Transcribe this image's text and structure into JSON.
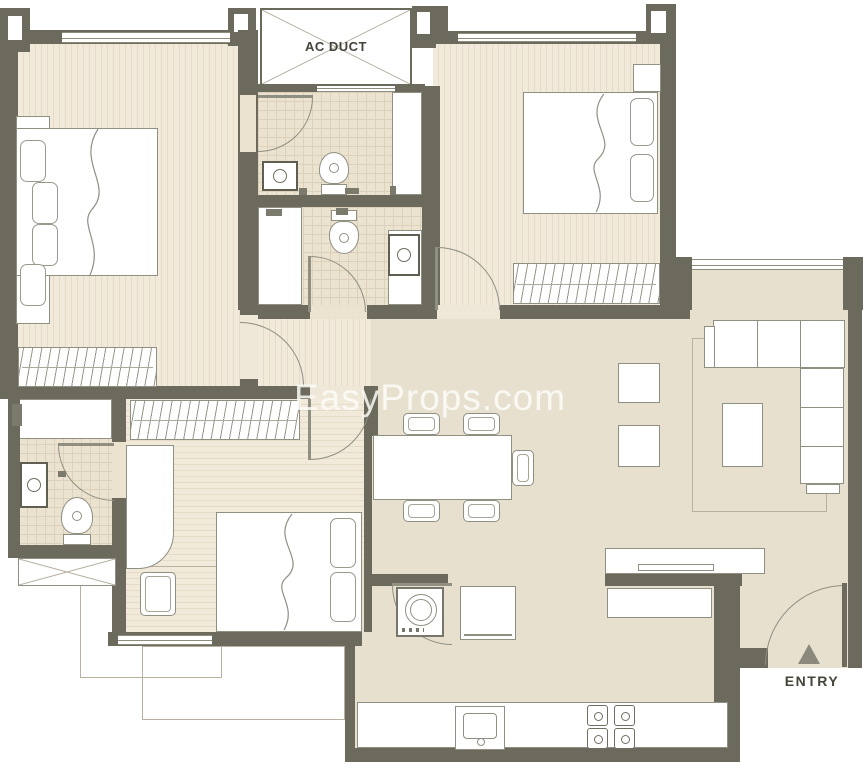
{
  "meta": {
    "description": "2BHK-style apartment floor plan drawing",
    "canvas": {
      "width": 866,
      "height": 768
    }
  },
  "labels": {
    "ac_duct": "AC DUCT",
    "entry": "ENTRY",
    "watermark": "EasyProps.com"
  },
  "colors": {
    "wall": "#6b6a5c",
    "floor_wood": "#f1e9d9",
    "floor_wood_stripe": "#e5dbc6",
    "floor_tile": "#ece2d0",
    "tile_line": "#dcd1bb",
    "floor_plain": "#e8e0cf",
    "furniture_line": "#8f8f82",
    "label_text": "#45443a",
    "watermark": "rgba(252,252,248,0.85)",
    "entry_triangle": "#8a897b"
  },
  "elements": [
    {
      "t": "floorw",
      "n": "bedroom-1-floor",
      "x": 18,
      "y": 44,
      "w": 222,
      "h": 342
    },
    {
      "t": "floorw",
      "n": "hallway-floor",
      "x": 258,
      "y": 310,
      "w": 114,
      "h": 76
    },
    {
      "t": "floorw",
      "n": "bedroom-2-floor",
      "x": 433,
      "y": 43,
      "w": 227,
      "h": 264
    },
    {
      "t": "floorwh",
      "n": "bedroom-3-floor",
      "x": 126,
      "y": 399,
      "w": 238,
      "h": 233
    },
    {
      "t": "floort",
      "n": "bath-1-floor",
      "x": 258,
      "y": 92,
      "w": 164,
      "h": 103
    },
    {
      "t": "floort",
      "n": "bath-2-floor",
      "x": 258,
      "y": 207,
      "w": 164,
      "h": 98
    },
    {
      "t": "floort",
      "n": "bath-3-floor",
      "x": 18,
      "y": 399,
      "w": 94,
      "h": 146
    },
    {
      "t": "floorp",
      "n": "living-dining-floor",
      "x": 372,
      "y": 310,
      "w": 476,
      "h": 350
    },
    {
      "t": "floorp",
      "n": "living-top-floor",
      "x": 676,
      "y": 262,
      "w": 172,
      "h": 48
    },
    {
      "t": "floorp",
      "n": "kitchen-floor",
      "x": 348,
      "y": 560,
      "w": 366,
      "h": 188
    },
    {
      "t": "floorp",
      "n": "entry-hall-floor",
      "x": 740,
      "y": 566,
      "w": 108,
      "h": 102
    },
    {
      "t": "rect",
      "n": "bath-1-shower",
      "x": 392,
      "y": 92,
      "w": 30,
      "h": 103
    },
    {
      "t": "rect",
      "n": "bath-2-counter",
      "x": 258,
      "y": 207,
      "w": 44,
      "h": 98
    },
    {
      "t": "rect",
      "n": "bath-2-shower",
      "x": 388,
      "y": 230,
      "w": 34,
      "h": 75
    },
    {
      "t": "rect",
      "n": "bath-3-shower",
      "x": 18,
      "y": 399,
      "w": 94,
      "h": 40
    },
    {
      "t": "trect",
      "n": "balcony-left",
      "x": 80,
      "y": 566,
      "w": 142,
      "h": 112
    },
    {
      "t": "trect",
      "n": "balcony-bottom",
      "x": 142,
      "y": 646,
      "w": 203,
      "h": 74
    },
    {
      "t": "wall",
      "n": "wall-top-left",
      "x": 0,
      "y": 30,
      "w": 256,
      "h": 14
    },
    {
      "t": "wall",
      "n": "wall-left",
      "x": 0,
      "y": 44,
      "w": 18,
      "h": 342
    },
    {
      "t": "wall",
      "n": "pillar-top-left",
      "x": 0,
      "y": 8,
      "w": 30,
      "h": 44
    },
    {
      "t": "white",
      "n": "pillar-top-left-notch",
      "x": 8,
      "y": 16,
      "w": 14,
      "h": 24
    },
    {
      "t": "wall",
      "n": "pillar-top-mid",
      "x": 228,
      "y": 8,
      "w": 28,
      "h": 38
    },
    {
      "t": "white",
      "n": "pillar-top-mid-notch",
      "x": 234,
      "y": 14,
      "w": 14,
      "h": 18
    },
    {
      "t": "wall",
      "n": "wall-bedroom1-right",
      "x": 238,
      "y": 30,
      "w": 20,
      "h": 280
    },
    {
      "t": "gapt",
      "n": "bath-1-door-gap",
      "x": 240,
      "y": 95,
      "w": 16,
      "h": 57
    },
    {
      "t": "wall",
      "n": "pillar-duct-right",
      "x": 412,
      "y": 6,
      "w": 24,
      "h": 42
    },
    {
      "t": "white",
      "n": "pillar-duct-right-notch",
      "x": 417,
      "y": 12,
      "w": 13,
      "h": 22
    },
    {
      "t": "wall",
      "n": "wall-top-bedroom2",
      "x": 430,
      "y": 31,
      "w": 220,
      "h": 13
    },
    {
      "t": "wall",
      "n": "pillar-bedroom2-left",
      "x": 430,
      "y": 6,
      "w": 18,
      "h": 36
    },
    {
      "t": "wall",
      "n": "pillar-bedroom2-right",
      "x": 646,
      "y": 4,
      "w": 30,
      "h": 40
    },
    {
      "t": "white",
      "n": "pillar-bedroom2-right-notch",
      "x": 651,
      "y": 11,
      "w": 15,
      "h": 22
    },
    {
      "t": "wall",
      "n": "wall-bedroom2-right",
      "x": 660,
      "y": 43,
      "w": 16,
      "h": 216
    },
    {
      "t": "wall",
      "n": "pillar-living-left",
      "x": 660,
      "y": 257,
      "w": 32,
      "h": 53
    },
    {
      "t": "wall",
      "n": "pillar-living-right",
      "x": 843,
      "y": 257,
      "w": 20,
      "h": 53
    },
    {
      "t": "wall",
      "n": "wall-living-right",
      "x": 848,
      "y": 266,
      "w": 14,
      "h": 402
    },
    {
      "t": "wall",
      "n": "wall-baths-right",
      "x": 422,
      "y": 86,
      "w": 18,
      "h": 224
    },
    {
      "t": "wall",
      "n": "wall-duct-bottom",
      "x": 258,
      "y": 84,
      "w": 167,
      "h": 8
    },
    {
      "t": "wall",
      "n": "wall-bath-divider",
      "x": 258,
      "y": 195,
      "w": 164,
      "h": 12
    },
    {
      "t": "wall",
      "n": "wall-mid",
      "x": 258,
      "y": 305,
      "w": 432,
      "h": 14
    },
    {
      "t": "gapt",
      "n": "bath-2-door-gap",
      "x": 310,
      "y": 305,
      "w": 57,
      "h": 14
    },
    {
      "t": "gapw",
      "n": "bedroom-2-door-gap",
      "x": 437,
      "y": 305,
      "w": 63,
      "h": 14
    },
    {
      "t": "wall",
      "n": "wall-hall-bottom",
      "x": 0,
      "y": 386,
      "w": 372,
      "h": 13
    },
    {
      "t": "gapw",
      "n": "bedroom-3-door-gap",
      "x": 310,
      "y": 386,
      "w": 61,
      "h": 13
    },
    {
      "t": "wall",
      "n": "wall-hall-vertical",
      "x": 240,
      "y": 310,
      "w": 18,
      "h": 76
    },
    {
      "t": "gapw",
      "n": "bedroom-1-door-gap",
      "x": 240,
      "y": 315,
      "w": 18,
      "h": 64
    },
    {
      "t": "wall",
      "n": "wall-bath3-left",
      "x": 8,
      "y": 399,
      "w": 12,
      "h": 159
    },
    {
      "t": "wall",
      "n": "wall-bath3-right",
      "x": 112,
      "y": 388,
      "w": 14,
      "h": 167
    },
    {
      "t": "gapt",
      "n": "bath-3-door-gap",
      "x": 112,
      "y": 442,
      "w": 14,
      "h": 56
    },
    {
      "t": "wall",
      "n": "wall-bath3-bottom",
      "x": 8,
      "y": 545,
      "w": 118,
      "h": 13
    },
    {
      "t": "wall",
      "n": "wall-bedroom3-right",
      "x": 364,
      "y": 386,
      "w": 14,
      "h": 50
    },
    {
      "t": "wall",
      "n": "wall-bedroom3-right-low",
      "x": 364,
      "y": 436,
      "w": 8,
      "h": 196
    },
    {
      "t": "wall",
      "n": "wall-bedroom3-bottom",
      "x": 108,
      "y": 632,
      "w": 254,
      "h": 14
    },
    {
      "t": "wall",
      "n": "wall-bedroom3-left-low",
      "x": 112,
      "y": 555,
      "w": 14,
      "h": 91
    },
    {
      "t": "wall",
      "n": "wall-kitchen-top",
      "x": 372,
      "y": 574,
      "w": 76,
      "h": 12
    },
    {
      "t": "wall",
      "n": "wall-half",
      "x": 605,
      "y": 574,
      "w": 137,
      "h": 12
    },
    {
      "t": "wall",
      "n": "wall-kitchen-entry",
      "x": 714,
      "y": 580,
      "w": 26,
      "h": 182
    },
    {
      "t": "wall",
      "n": "wall-entry-stub",
      "x": 740,
      "y": 648,
      "w": 28,
      "h": 20
    },
    {
      "t": "wall",
      "n": "wall-kitchen-bottom",
      "x": 345,
      "y": 748,
      "w": 385,
      "h": 14
    },
    {
      "t": "wall",
      "n": "wall-kitchen-left",
      "x": 345,
      "y": 585,
      "w": 10,
      "h": 177
    },
    {
      "t": "win",
      "n": "window-bedroom-1",
      "x": 62,
      "y": 32,
      "w": 168,
      "h": 11
    },
    {
      "t": "win",
      "n": "window-bedroom-2",
      "x": 458,
      "y": 33,
      "w": 178,
      "h": 9
    },
    {
      "t": "win",
      "n": "window-living",
      "x": 692,
      "y": 259,
      "w": 151,
      "h": 11
    },
    {
      "t": "win",
      "n": "window-bedroom-3",
      "x": 118,
      "y": 635,
      "w": 94,
      "h": 10
    },
    {
      "t": "win",
      "n": "window-bath-1",
      "x": 317,
      "y": 84,
      "w": 78,
      "h": 8
    },
    {
      "t": "xbox",
      "n": "ac-duct-box",
      "x": 260,
      "y": 8,
      "w": 152,
      "h": 78,
      "bw": 2
    },
    {
      "t": "xbox",
      "n": "shaft-box",
      "x": 18,
      "y": 558,
      "w": 98,
      "h": 28,
      "bw": 1
    },
    {
      "t": "arctl",
      "n": "bath-1-door-arc",
      "x": 258,
      "y": 97,
      "w": 55,
      "h": 55
    },
    {
      "t": "line",
      "n": "bath-1-door-leaf",
      "x": 258,
      "y": 95,
      "w": 55,
      "h": 3
    },
    {
      "t": "arcbl",
      "n": "bath-2-door-arc",
      "x": 310,
      "y": 256,
      "w": 56,
      "h": 56
    },
    {
      "t": "line",
      "n": "bath-2-door-leaf",
      "x": 308,
      "y": 256,
      "w": 3,
      "h": 56
    },
    {
      "t": "arcbl",
      "n": "bedroom-2-door-arc",
      "x": 437,
      "y": 247,
      "w": 63,
      "h": 63
    },
    {
      "t": "line",
      "n": "bedroom-2-door-leaf",
      "x": 435,
      "y": 247,
      "w": 3,
      "h": 63
    },
    {
      "t": "arcbl",
      "n": "bedroom-1-door-arc",
      "x": 240,
      "y": 322,
      "w": 64,
      "h": 64
    },
    {
      "t": "arctl",
      "n": "bedroom-3-door-arc",
      "x": 310,
      "y": 399,
      "w": 61,
      "h": 61
    },
    {
      "t": "line",
      "n": "bedroom-3-door-leaf",
      "x": 308,
      "y": 399,
      "w": 3,
      "h": 61
    },
    {
      "t": "arctr",
      "n": "bath-3-door-arc",
      "x": 58,
      "y": 445,
      "w": 56,
      "h": 56
    },
    {
      "t": "line",
      "n": "bath-3-door-leaf",
      "x": 58,
      "y": 443,
      "w": 56,
      "h": 3
    },
    {
      "t": "arctr",
      "n": "kitchen-door-arc",
      "x": 392,
      "y": 585,
      "w": 60,
      "h": 60
    },
    {
      "t": "line",
      "n": "kitchen-door-leaf",
      "x": 392,
      "y": 583,
      "w": 60,
      "h": 3
    },
    {
      "t": "arcbr",
      "n": "entry-door-arc",
      "x": 765,
      "y": 585,
      "w": 80,
      "h": 80
    },
    {
      "t": "line",
      "n": "entry-door-leaf",
      "x": 842,
      "y": 583,
      "w": 5,
      "h": 84,
      "c": "#6b6a5c"
    },
    {
      "t": "rect",
      "n": "bed-1-headboard",
      "x": 16,
      "y": 116,
      "w": 34,
      "h": 208
    },
    {
      "t": "rect",
      "n": "bed-1",
      "x": 16,
      "y": 128,
      "w": 142,
      "h": 148
    },
    {
      "t": "pillow",
      "n": "bed-1-pillow",
      "x": 20,
      "y": 140,
      "w": 26,
      "h": 42
    },
    {
      "t": "pillow",
      "n": "bed-1-pillow",
      "x": 32,
      "y": 182,
      "w": 26,
      "h": 42
    },
    {
      "t": "pillow",
      "n": "bed-1-pillow",
      "x": 32,
      "y": 224,
      "w": 26,
      "h": 42
    },
    {
      "t": "pillow",
      "n": "bed-1-pillow",
      "x": 20,
      "y": 264,
      "w": 26,
      "h": 42
    },
    {
      "t": "wave",
      "n": "bed-1-blanket-fold",
      "x": 68,
      "y": 129,
      "w": 50,
      "h": 146
    },
    {
      "t": "ward",
      "n": "wardrobe-1",
      "x": 18,
      "y": 347,
      "w": 139,
      "h": 40
    },
    {
      "t": "rect",
      "n": "bed-2-side-table",
      "x": 633,
      "y": 64,
      "w": 28,
      "h": 28
    },
    {
      "t": "rect",
      "n": "bed-2",
      "x": 523,
      "y": 92,
      "w": 135,
      "h": 122
    },
    {
      "t": "pillow",
      "n": "bed-2-pillow",
      "x": 630,
      "y": 98,
      "w": 24,
      "h": 48
    },
    {
      "t": "pillow",
      "n": "bed-2-pillow",
      "x": 630,
      "y": 154,
      "w": 24,
      "h": 48
    },
    {
      "t": "wave",
      "n": "bed-2-blanket-fold",
      "x": 575,
      "y": 94,
      "w": 48,
      "h": 118
    },
    {
      "t": "ward",
      "n": "wardrobe-2",
      "x": 513,
      "y": 263,
      "w": 147,
      "h": 41
    },
    {
      "t": "sinkv",
      "n": "bath-1-sink",
      "x": 262,
      "y": 161,
      "w": 36,
      "h": 30
    },
    {
      "t": "toilet",
      "n": "bath-1-toilet",
      "x": 318,
      "y": 152,
      "w": 32,
      "h": 43,
      "d": "up"
    },
    {
      "t": "acc",
      "n": "bath-1-fixture",
      "x": 299,
      "y": 188,
      "w": 8,
      "h": 7
    },
    {
      "t": "acc",
      "n": "bath-1-fixture",
      "x": 345,
      "y": 188,
      "w": 14,
      "h": 6
    },
    {
      "t": "acc",
      "n": "bath-1-fixture",
      "x": 390,
      "y": 186,
      "w": 6,
      "h": 9
    },
    {
      "t": "toilet",
      "n": "bath-2-toilet",
      "x": 328,
      "y": 210,
      "w": 32,
      "h": 44,
      "d": "down"
    },
    {
      "t": "sinkv",
      "n": "bath-2-sink",
      "x": 388,
      "y": 234,
      "w": 32,
      "h": 42
    },
    {
      "t": "acc",
      "n": "bath-2-fixture",
      "x": 266,
      "y": 209,
      "w": 16,
      "h": 7
    },
    {
      "t": "acc",
      "n": "bath-2-fixture",
      "x": 336,
      "y": 208,
      "w": 12,
      "h": 7
    },
    {
      "t": "sinkv",
      "n": "bath-3-sink",
      "x": 20,
      "y": 462,
      "w": 28,
      "h": 46
    },
    {
      "t": "toilet",
      "n": "bath-3-toilet",
      "x": 60,
      "y": 497,
      "w": 34,
      "h": 48,
      "d": "up"
    },
    {
      "t": "acc",
      "n": "bath-3-fixture",
      "x": 12,
      "y": 404,
      "w": 10,
      "h": 22
    },
    {
      "t": "acc",
      "n": "bath-3-fixture",
      "x": 58,
      "y": 471,
      "w": 8,
      "h": 6
    },
    {
      "t": "ward",
      "n": "wardrobe-3",
      "x": 130,
      "y": 400,
      "w": 170,
      "h": 40
    },
    {
      "t": "rect",
      "n": "desk",
      "x": 126,
      "y": 445,
      "w": 48,
      "h": 124,
      "br": "0 0 36px 0"
    },
    {
      "t": "chair",
      "n": "desk-chair",
      "x": 140,
      "y": 572,
      "w": 36,
      "h": 44
    },
    {
      "t": "rect",
      "n": "bed-3",
      "x": 216,
      "y": 512,
      "w": 146,
      "h": 120
    },
    {
      "t": "pillow",
      "n": "bed-3-pillow",
      "x": 330,
      "y": 518,
      "w": 26,
      "h": 50
    },
    {
      "t": "pillow",
      "n": "bed-3-pillow",
      "x": 330,
      "y": 572,
      "w": 26,
      "h": 50
    },
    {
      "t": "wave",
      "n": "bed-3-blanket-fold",
      "x": 262,
      "y": 514,
      "w": 50,
      "h": 116
    },
    {
      "t": "trect",
      "n": "living-rug",
      "x": 692,
      "y": 338,
      "w": 135,
      "h": 174
    },
    {
      "t": "rect",
      "n": "sofa-main",
      "x": 713,
      "y": 320,
      "w": 132,
      "h": 48
    },
    {
      "t": "rect",
      "n": "sofa-arm",
      "x": 704,
      "y": 326,
      "w": 11,
      "h": 42
    },
    {
      "t": "rect",
      "n": "sofa-right",
      "x": 800,
      "y": 368,
      "w": 44,
      "h": 116
    },
    {
      "t": "rect",
      "n": "sofa-end",
      "x": 806,
      "y": 484,
      "w": 34,
      "h": 10
    },
    {
      "t": "line",
      "n": "sofa-cushion-line",
      "x": 757,
      "y": 321,
      "w": 1,
      "h": 46
    },
    {
      "t": "line",
      "n": "sofa-cushion-line",
      "x": 800,
      "y": 321,
      "w": 1,
      "h": 46
    },
    {
      "t": "line",
      "n": "sofa-cushion-line",
      "x": 801,
      "y": 407,
      "w": 42,
      "h": 1
    },
    {
      "t": "line",
      "n": "sofa-cushion-line",
      "x": 801,
      "y": 446,
      "w": 42,
      "h": 1
    },
    {
      "t": "rect",
      "n": "coffee-table",
      "x": 722,
      "y": 403,
      "w": 41,
      "h": 64
    },
    {
      "t": "rect",
      "n": "ottoman-1",
      "x": 618,
      "y": 363,
      "w": 42,
      "h": 40
    },
    {
      "t": "rect",
      "n": "ottoman-2",
      "x": 618,
      "y": 425,
      "w": 42,
      "h": 42
    },
    {
      "t": "chair",
      "n": "dining-chair",
      "x": 403,
      "y": 413,
      "w": 37,
      "h": 22
    },
    {
      "t": "chair",
      "n": "dining-chair",
      "x": 463,
      "y": 413,
      "w": 37,
      "h": 22
    },
    {
      "t": "chair",
      "n": "dining-chair",
      "x": 403,
      "y": 500,
      "w": 37,
      "h": 22
    },
    {
      "t": "chair",
      "n": "dining-chair",
      "x": 463,
      "y": 500,
      "w": 37,
      "h": 22
    },
    {
      "t": "chair",
      "n": "dining-chair",
      "x": 512,
      "y": 450,
      "w": 22,
      "h": 36
    },
    {
      "t": "rect",
      "n": "dining-table",
      "x": 373,
      "y": 435,
      "w": 139,
      "h": 65
    },
    {
      "t": "rect",
      "n": "kitchen-counter",
      "x": 357,
      "y": 702,
      "w": 371,
      "h": 46
    },
    {
      "t": "ksink",
      "n": "kitchen-sink",
      "x": 455,
      "y": 706,
      "w": 50,
      "h": 44
    },
    {
      "t": "stove",
      "n": "stove",
      "x": 583,
      "y": 702,
      "w": 56,
      "h": 48
    },
    {
      "t": "washer",
      "n": "washing-machine",
      "x": 396,
      "y": 587,
      "w": 48,
      "h": 50
    },
    {
      "t": "rect",
      "n": "fridge",
      "x": 460,
      "y": 586,
      "w": 56,
      "h": 54
    },
    {
      "t": "line",
      "n": "fridge-handle",
      "x": 464,
      "y": 634,
      "w": 48,
      "h": 2
    },
    {
      "t": "rect",
      "n": "counter-upper",
      "x": 605,
      "y": 548,
      "w": 160,
      "h": 26
    },
    {
      "t": "rect",
      "n": "counter-shelf",
      "x": 638,
      "y": 564,
      "w": 76,
      "h": 7
    },
    {
      "t": "rect",
      "n": "counter-lower",
      "x": 607,
      "y": 588,
      "w": 105,
      "h": 30
    },
    {
      "t": "tri",
      "n": "entry-marker",
      "x": 798,
      "y": 644,
      "w": 22,
      "h": 20
    }
  ]
}
